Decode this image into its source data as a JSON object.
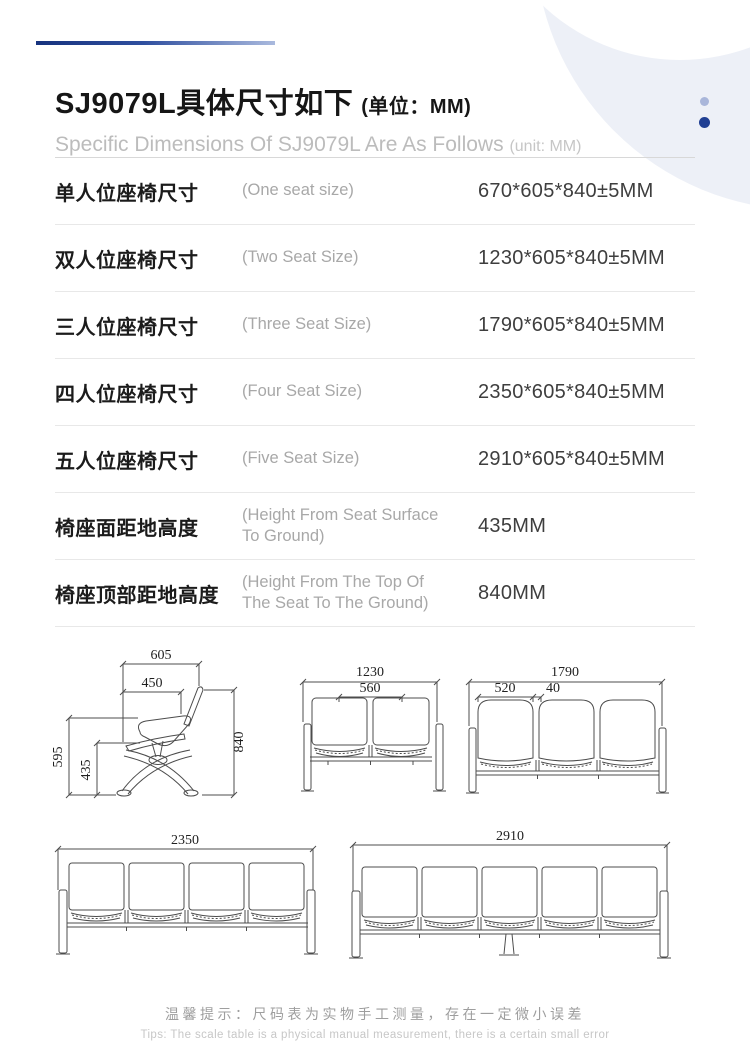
{
  "header": {
    "title_zh": "SJ9079L具体尺寸如下",
    "unit_zh": "(单位：MM)",
    "subtitle_en": "Specific Dimensions Of SJ9079L Are As Follows",
    "subtitle_unit": "(unit: MM)"
  },
  "table": {
    "rows": [
      {
        "label_zh": "单人位座椅尺寸",
        "label_en": "(One seat size)",
        "value": "670*605*840±5MM"
      },
      {
        "label_zh": "双人位座椅尺寸",
        "label_en": "(Two Seat Size)",
        "value": "1230*605*840±5MM"
      },
      {
        "label_zh": "三人位座椅尺寸",
        "label_en": "(Three Seat Size)",
        "value": "1790*605*840±5MM"
      },
      {
        "label_zh": "四人位座椅尺寸",
        "label_en": "(Four Seat Size)",
        "value": "2350*605*840±5MM"
      },
      {
        "label_zh": "五人位座椅尺寸",
        "label_en": "(Five Seat Size)",
        "value": "2910*605*840±5MM"
      },
      {
        "label_zh": "椅座面距地高度",
        "label_en": "(Height From Seat Surface To Ground)",
        "value": "435MM"
      },
      {
        "label_zh": "椅座顶部距地高度",
        "label_en": "(Height From The Top Of The Seat To The Ground)",
        "value": "840MM"
      }
    ]
  },
  "diagrams": {
    "single": {
      "top_width": "605",
      "seat_depth": "450",
      "total_height": "840",
      "back_height": "595",
      "seat_height": "435"
    },
    "two_seat": {
      "overall_width": "1230",
      "seat_width": "560"
    },
    "three_seat": {
      "overall_width": "1790",
      "seat_width": "520",
      "gap": "40"
    },
    "four_seat": {
      "overall_width": "2350"
    },
    "five_seat": {
      "overall_width": "2910"
    }
  },
  "tips": {
    "zh": "温馨提示：尺码表为实物手工测量，存在一定微小误差",
    "en": "Tips: The scale table is a physical manual measurement, there is a certain small error"
  },
  "colors": {
    "accent_blue": "#17337e",
    "dot_light": "#a9b6da",
    "dot_dark": "#203f93",
    "deco_gray": "#edf0f7"
  }
}
